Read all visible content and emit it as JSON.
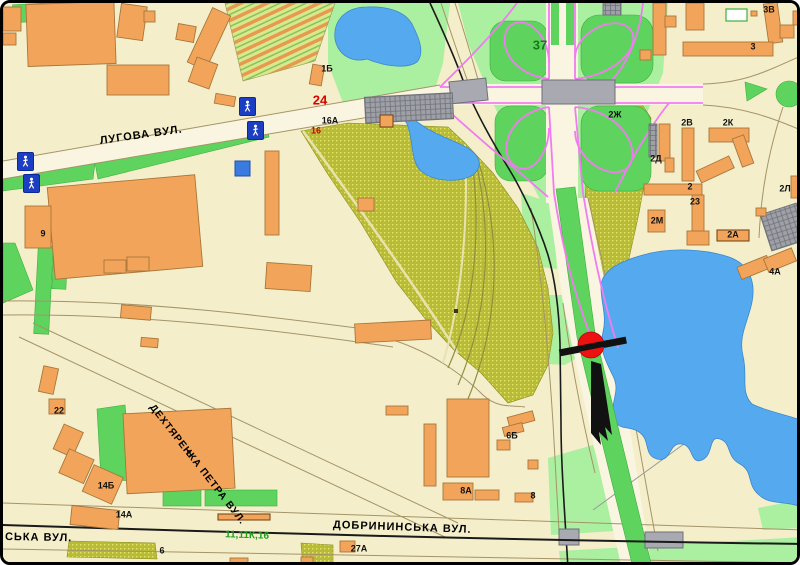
{
  "map": {
    "title": "city-map-with-location-marker",
    "streets": [
      {
        "name": "ЛУГОВА ВУЛ.",
        "x": 97,
        "y": 133,
        "rotate": -8,
        "size": 11
      },
      {
        "name": "ДЕХТЯРЕНКА ПЕТРА ВУЛ.",
        "x": 148,
        "y": 398,
        "rotate": 52,
        "size": 10
      },
      {
        "name": "ДОБРИНИНСЬКА ВУЛ.",
        "x": 330,
        "y": 517,
        "rotate": 2,
        "size": 11
      },
      {
        "name": "СЬКА ВУЛ.",
        "x": 2,
        "y": 529,
        "rotate": 1,
        "size": 11
      }
    ],
    "route_badges": [
      {
        "text": "24",
        "x": 317,
        "y": 97,
        "color": "#dd0000",
        "size": 13,
        "rotate": 0
      },
      {
        "text": "37",
        "x": 537,
        "y": 42,
        "color": "#157a15",
        "size": 13,
        "rotate": 0
      },
      {
        "text": "11,11К,16",
        "x": 244,
        "y": 533,
        "color": "#1e9e1e",
        "size": 10,
        "rotate": 2
      }
    ],
    "building_labels": [
      {
        "text": "9",
        "x": 40,
        "y": 231
      },
      {
        "text": "1Б",
        "x": 324,
        "y": 66
      },
      {
        "text": "16А",
        "x": 327,
        "y": 118
      },
      {
        "text": "16",
        "x": 313,
        "y": 128,
        "color": "#cc0000"
      },
      {
        "text": "2Ж",
        "x": 612,
        "y": 112
      },
      {
        "text": "2В",
        "x": 684,
        "y": 120
      },
      {
        "text": "2К",
        "x": 725,
        "y": 120
      },
      {
        "text": "2Д",
        "x": 653,
        "y": 156
      },
      {
        "text": "2Л",
        "x": 782,
        "y": 186
      },
      {
        "text": "2",
        "x": 687,
        "y": 184
      },
      {
        "text": "23",
        "x": 692,
        "y": 199
      },
      {
        "text": "2М",
        "x": 654,
        "y": 218
      },
      {
        "text": "2А",
        "x": 730,
        "y": 232
      },
      {
        "text": "4А",
        "x": 772,
        "y": 269
      },
      {
        "text": "3",
        "x": 750,
        "y": 44
      },
      {
        "text": "3В",
        "x": 766,
        "y": 7
      },
      {
        "text": "22",
        "x": 56,
        "y": 408
      },
      {
        "text": "14Б",
        "x": 103,
        "y": 483
      },
      {
        "text": "14А",
        "x": 121,
        "y": 512
      },
      {
        "text": "8",
        "x": 186,
        "y": 451
      },
      {
        "text": "6",
        "x": 159,
        "y": 548
      },
      {
        "text": "6Б",
        "x": 509,
        "y": 433
      },
      {
        "text": "8А",
        "x": 463,
        "y": 488
      },
      {
        "text": "8",
        "x": 530,
        "y": 493
      },
      {
        "text": "27А",
        "x": 356,
        "y": 546
      }
    ],
    "icons": [
      {
        "type": "pedestrian-crossing",
        "x": 236,
        "y": 94
      },
      {
        "type": "pedestrian-crossing",
        "x": 244,
        "y": 118
      },
      {
        "type": "pedestrian-crossing",
        "x": 14,
        "y": 149
      },
      {
        "type": "pedestrian-crossing",
        "x": 20,
        "y": 171
      }
    ],
    "marker": {
      "type": "highlighted-billboard-location",
      "shape": "red circle with black bar and arrow"
    },
    "colors": {
      "background": "#f4eecb",
      "building": "#f2a55a",
      "water": "#55aaef",
      "park_green": "#5ed45e",
      "pale_green": "#abefa0",
      "industrial_hatch": "#b8bb37",
      "highway_ramp": "#f07cf0",
      "marker_red": "#ee1111",
      "route_red": "#dd0000",
      "route_green": "#157a15"
    }
  }
}
